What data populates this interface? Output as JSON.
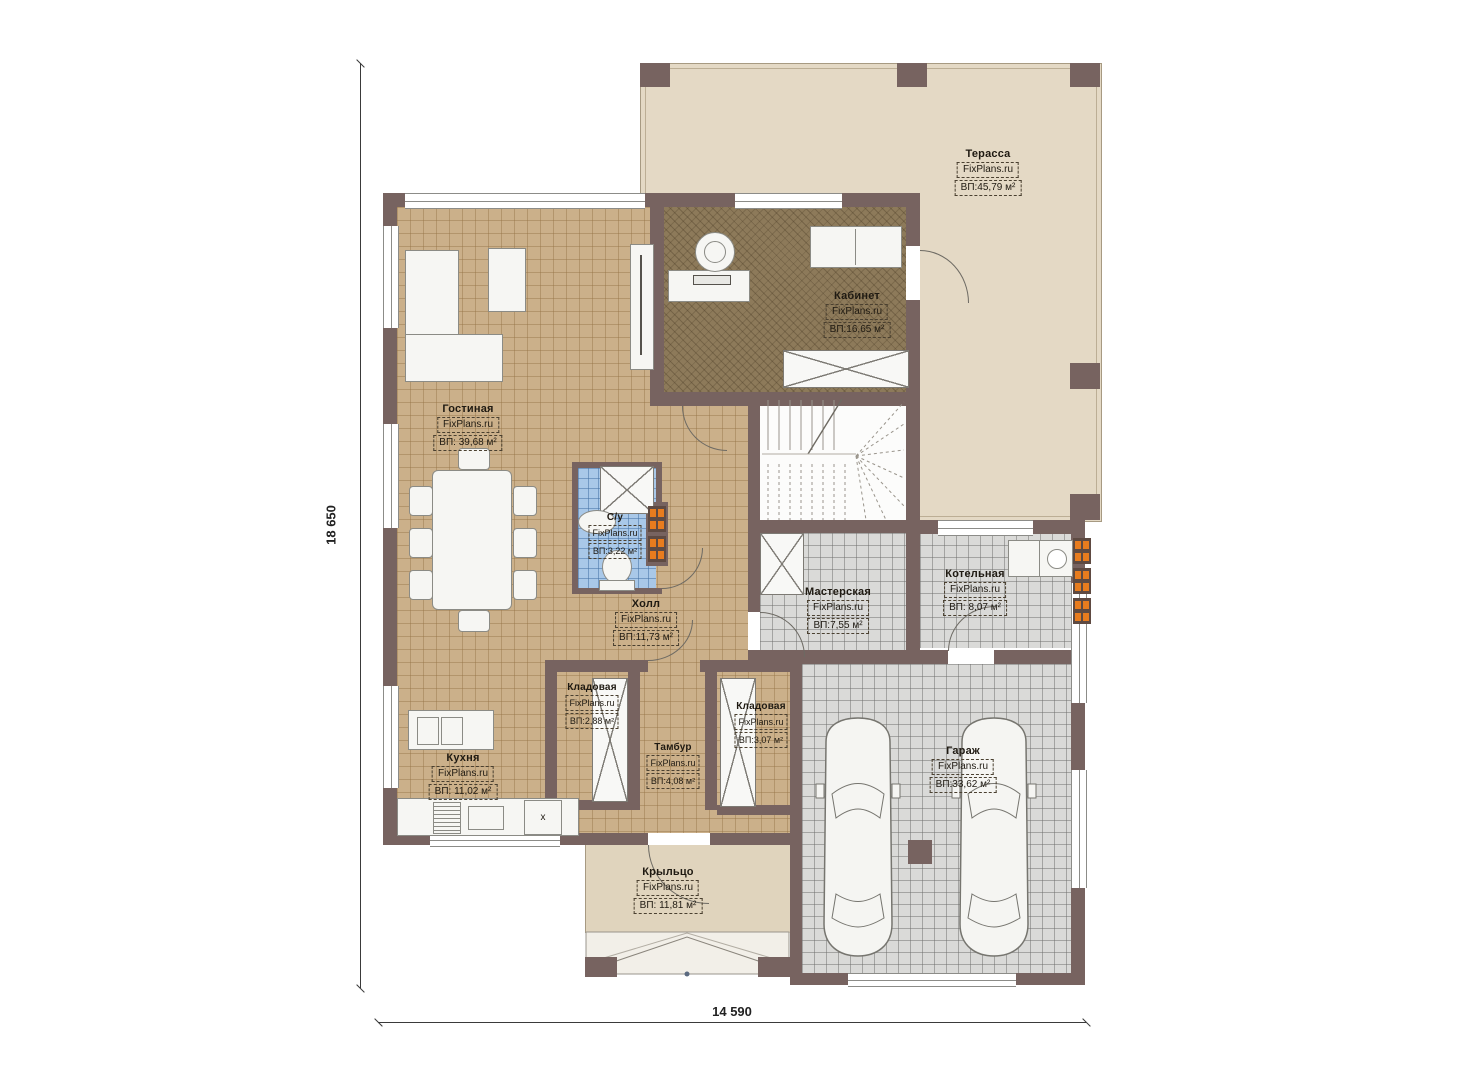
{
  "title": "План первого этажа",
  "site": "FixPlans.ru",
  "dimensions": {
    "vertical": "18 650",
    "horizontal": "14 590"
  },
  "colors": {
    "wall": "#776360",
    "floor_tan": "#cbb08a",
    "floor_office": "#8d7a5a",
    "floor_bath": "#a9c8e8",
    "floor_gray": "#dadad8",
    "terrace": "#e4d9c5",
    "porch": "#e0d4bd",
    "radiator_orange": "#e87c1e"
  },
  "rooms": {
    "terrace": {
      "name": "Терасса",
      "site": "FixPlans.ru",
      "area": "ВП:45,79 м²"
    },
    "office": {
      "name": "Кабинет",
      "site": "FixPlans.ru",
      "area": "ВП:16,65 м²"
    },
    "living": {
      "name": "Гостиная",
      "site": "FixPlans.ru",
      "area": "ВП: 39,68 м²"
    },
    "bath": {
      "name": "С/у",
      "site": "FixPlans.ru",
      "area": "ВП:3,22 м²"
    },
    "hall": {
      "name": "Холл",
      "site": "FixPlans.ru",
      "area": "ВП:11,73 м²"
    },
    "workshop": {
      "name": "Мастерская",
      "site": "FixPlans.ru",
      "area": "ВП:7,55 м²"
    },
    "boiler": {
      "name": "Котельная",
      "site": "FixPlans.ru",
      "area": "ВП: 8,07 м²"
    },
    "storage1": {
      "name": "Кладовая",
      "site": "FixPlans.ru",
      "area": "ВП:2,88 м²"
    },
    "storage2": {
      "name": "Кладовая",
      "site": "FixPlans.ru",
      "area": "ВП:3,07 м²"
    },
    "vestibule": {
      "name": "Тамбур",
      "site": "FixPlans.ru",
      "area": "ВП:4,08 м²"
    },
    "kitchen": {
      "name": "Кухня",
      "site": "FixPlans.ru",
      "area": "ВП: 11,02 м²"
    },
    "garage": {
      "name": "Гараж",
      "site": "FixPlans.ru",
      "area": "ВП:33,62 м²"
    },
    "porch": {
      "name": "Крыльцо",
      "site": "FixPlans.ru",
      "area": "ВП: 11,81 м²"
    }
  },
  "symbols": {
    "washer_mark": "x"
  }
}
